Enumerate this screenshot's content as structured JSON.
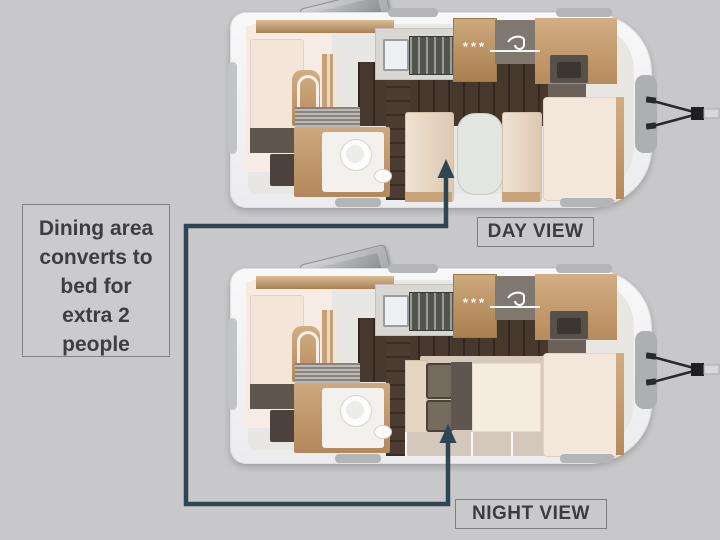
{
  "annotation": {
    "lines": [
      "Dining area",
      "converts to",
      "bed for",
      "extra 2",
      "people"
    ]
  },
  "labels": {
    "day": "DAY VIEW",
    "night": "NIGHT VIEW"
  },
  "decorations": {
    "freezer_stars": "***"
  },
  "colors": {
    "background": "#c8c8ca",
    "connector": "#2e4553",
    "wood": "#c9a277",
    "dark_floor": "#46382c",
    "mattress": "#f3e5d8",
    "shell": "#f4f4f5",
    "label_text": "#3c3c3e"
  }
}
